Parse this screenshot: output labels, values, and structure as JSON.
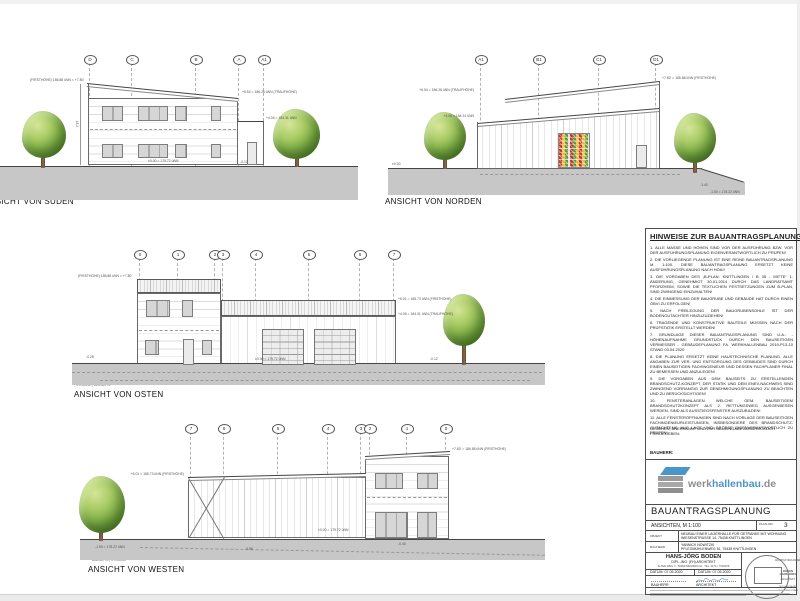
{
  "views": {
    "sued": {
      "label": "ANSICHT VON SÜDEN",
      "caption": "STRASSE | BAUSEITS",
      "grid": [
        "D",
        "C",
        "B",
        "A",
        "A1"
      ],
      "dims": [
        "(FIRSTHÖHE) 186.88 üNN = +7.80'",
        "+6.54 = 186.26 üNN (TRAUFHÖHE)",
        "+4.06 = 184.31 üNN",
        "±0.00 = 179.72 üNN",
        "-0.12",
        "7.97"
      ]
    },
    "nord": {
      "label": "ANSICHT VON NORDEN",
      "caption": "STRASSE | BAUSEITS",
      "grid": [
        "A1",
        "B1",
        "C1",
        "D1"
      ],
      "dims": [
        "+6.54 = 186.26 üNN (TRAUFHÖHE)",
        "+4.06 = 184.31 üNN",
        "+7.80' = 186.88 üNN (FIRSTHÖHE)",
        "-1.40",
        "-1.50 = 178.22 üNN",
        "±0.00"
      ]
    },
    "ost": {
      "label": "ANSICHT VON OSTEN",
      "caption": "STRASSE | BAUSEITS",
      "grid": [
        "0",
        "1",
        "2",
        "3",
        "4",
        "5",
        "6",
        "7"
      ],
      "dims": [
        "(FIRSTHÖHE) 186.88 üNN = +7.80'",
        "+6.01 = 185.73 üNN (FIRSTHÖHE)",
        "+4.06 = 184.31 üNN (TRAUFHÖHE)",
        "±0.00 = 179.72 üNN",
        "-0.28",
        "-0.12"
      ]
    },
    "west": {
      "label": "ANSICHT VON WESTEN",
      "caption": "BAUSEITS | STRASSE",
      "grid": [
        "7",
        "6",
        "5",
        "4",
        "3",
        "2",
        "1",
        "0"
      ],
      "dims": [
        "+6.01 = 185.73 üNN (FIRSTHÖHE)",
        "+7.80' = 186.88 üNN (FIRSTHÖHE)",
        "±0.00 = 179.72 üNN",
        "-1.50 = 178.22 üNN",
        "-0.95",
        "-0.45"
      ]
    }
  },
  "notes": {
    "title": "HINWEISE ZUR BAUANTRAGSPLANUNG:",
    "items": [
      "1. ALLE MASSE UND HÖHEN SIND VOR DER AUSFÜHRUNG BZW. VOR DER AUSFÜHRUNGSPLANUNG EIGENVERANTWORTLICH ZU PRÜFEN!",
      "2. DIE VORLIEGENDE PLANUNG IST EINE REINE BAUANTRAGSPLANUNG M. 1:100. DIESE BAUANTRAGSPLANUNG ERSETZT KEINE AUSFÜHRUNGSPLANUNG NACH HOAI!",
      "3. DIE VORGABEN DES „B-PLAN: KNITTLINGEN / B 35 - MITTE“ 1. ÄNDERUNG, GENEHMIGT 30.01.2014 DURCH DAS LANDRATSAMT PFORZHEIM, SOWIE DIE TEXTLICHEN FESTSETZUNGEN ZUM B-PLAN, SIND ZWINGEND EINZUHALTEN!",
      "4. DIE EINMESSUNG DER BAUGRUBE UND GEBÄUDE HAT DURCH EINEN ÖBVI ZU ERFOLGEN!",
      "5. NACH FREILEGUNG DER BAUGRUBENSOHLE IST DER BODENGUTACHTER HINZUZUZIEHEN!",
      "6. TRAGENDE UND KONSTRUKTIVE BAUTEILE MÜSSEN NACH DER PRÜFSTATIK ERSTELLT WERDEN!",
      "7. GRUNDLAGE DIESER BAUANTRAGSPLANUNG SIND U.A.: - HÖHENAUFNAHME GRUNDSTÜCK DURCH DEN BAUSEITIGEN VERMESSER - GEBÄUDEPLANUNG FA. WERKHALLENBAU 2019-P13-10 STAND 03.04.2020",
      "8. DIE PLANUNG ERSETZT KEINE HAUSTECHNISCHE PLANUNG. ALLE ANGABEN ZUR VER- UND ENTSORGUNG DES GEBÄUDES SIND DURCH EINEN BAUSEITIGEN FACHINGENIEUR UND DESSEN FACHPLANER FINAL ZU BEMESSEN UND ANZULEGEN!",
      "9. DIE VORGABEN AUS DEM BAUSEITS ZU ERSTELLENDEN BRANDSCHUTZ-KONZEPT, DER STATIK UND DEM ENEV-NACHWEIS SIND ZWINGEND VORRANGIG ZUR GENEHMIGUNGSPLANUNG ZU BEACHTEN UND ZU BERÜCKSICHTIGEN!",
      "10. FENSTERANLAGEN WELCHE GEM. BAUSEITIGEM BRANDSCHUTZKONZEPT ALS 2. RETTUNGSWEG AUSGEWIESEN WERDEN, SIND ALS AUSSTIEGSFENSTER AUSZUBILDEN!",
      "11. ALLE FENSTERÖFFNUNGEN SIND NACH VORLAGE DER BAUSEITIGEN FACHINGENIEURLEISTUNGEN, INSBESONDERE DES BRANDSCHUTZ-GUTACHTENS, AUF LAGE UND GRÖSSE EIGENVERANTWORTLICH ZU PRÜFEN!"
    ],
    "release": "GESEHEN, ANERKANNT UND ZUR BAUEINGABE AUSDRÜCKLICH FREIGEGEBEN:",
    "bauherr": "BAUHERR:"
  },
  "titleblock": {
    "logo_word1": "werk",
    "logo_word2": "hallenbau",
    "logo_word3": ".de",
    "logo_blue": "#4a96c8",
    "logo_gray": "#8e8e8e",
    "plan_type": "BAUANTRAGSPLANUNG",
    "sheet_name": "ANSICHTEN, M 1:100",
    "plan_nr_label": "PLAN-NR.",
    "plan_nr": "3",
    "objekt_label": "OBJEKT",
    "objekt1": "NEUBAU EINER LAGERHALLE FÜR GETRÄNKE MIT WOHNUNG",
    "objekt2": "WIESENSTRASSE 14, 75438 KNITTLINGEN",
    "bauherr_label": "BAUHERR",
    "bauherr1": "YANNICK NOWITZKI",
    "bauherr2": "PFLEGMÜHLENWEG 51, 75438 KNITTLINGEN",
    "arch_name": "HANS-JÖRG BODEN",
    "arch_title": "DIPL.-ING. (FH) ARCHITEKT",
    "arch_addr": "ALTER WEG 3 · 66999 MEILBRUCH · TEL. 0171 / 7649158",
    "datum1": "DATUM: 07.05.2020",
    "datum2": "DATUM: 07.05.2020",
    "sig1": "BAUHERR",
    "sig2": "ARCHITEKT",
    "stamp_l1": "ARCHITEKTENKAMMER",
    "stamp_l2": "BODEN",
    "stamp_l3": "HANS-JÖRG",
    "stamp_l4": "ARCHITEKT",
    "stamp_l5": "MITGLIED AKBW",
    "stamp_l6": "RHEINLAND-PFALZ"
  }
}
